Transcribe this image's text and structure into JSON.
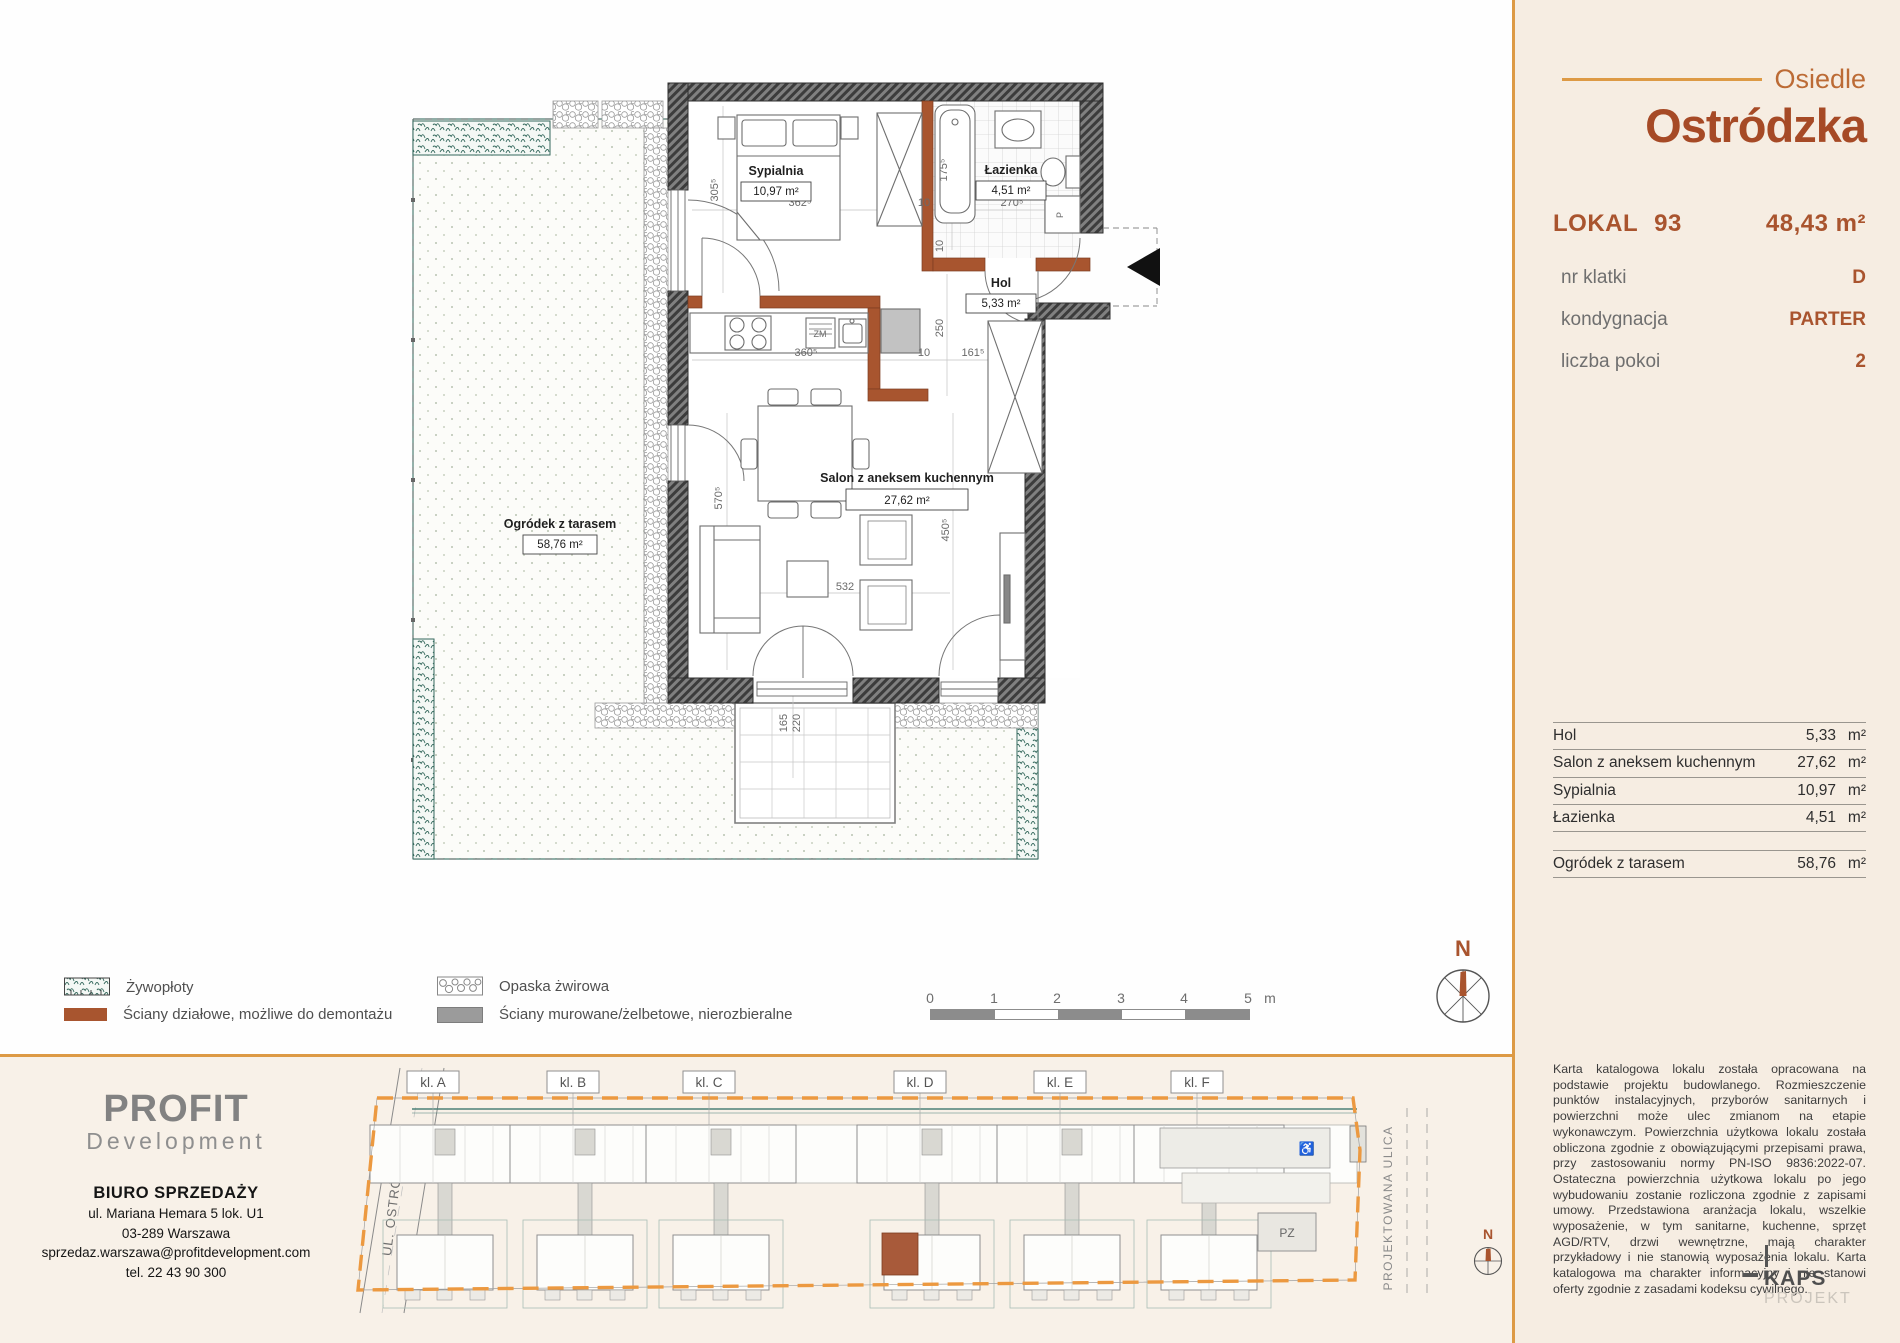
{
  "sidebar": {
    "brand": {
      "label": "Osiedle",
      "name": "Ostródzka"
    },
    "lokal": {
      "label": "LOKAL",
      "number": "93",
      "area": "48,43",
      "unit": "m²"
    },
    "attributes": [
      {
        "label": "nr klatki",
        "value": "D"
      },
      {
        "label": "kondygnacja",
        "value": "PARTER"
      },
      {
        "label": "liczba pokoi",
        "value": "2"
      }
    ],
    "rooms": [
      {
        "name": "Hol",
        "area": "5,33",
        "unit": "m²"
      },
      {
        "name": "Salon z aneksem kuchennym",
        "area": "27,62",
        "unit": "m²"
      },
      {
        "name": "Sypialnia",
        "area": "10,97",
        "unit": "m²"
      },
      {
        "name": "Łazienka",
        "area": "4,51",
        "unit": "m²"
      }
    ],
    "outdoor": {
      "name": "Ogródek z tarasem",
      "area": "58,76",
      "unit": "m²"
    },
    "disclaimer": "Karta katalogowa lokalu została opracowana na podstawie projektu budowlanego. Rozmieszczenie punktów instalacyjnych, przyborów sanitarnych i powierzchni może ulec zmianom na etapie wykonawczym. Powierzchnia użytkowa lokalu została obliczona zgodnie z obowiązującymi przepisami prawa, przy zastosowaniu normy PN-ISO 9836:2022-07. Ostateczna powierzchnia użytkowa lokalu po jego wybudowaniu zostanie rozliczona zgodnie z zapisami umowy. Przedstawiona aranżacja lokalu, wszelkie wyposażenie, w tym sanitarne, kuchenne, sprzęt AGD/RTV, drzwi wewnętrzne, mają charakter przykładowy i nie stanowią wyposażenia lokalu. Karta katalogowa ma charakter informacyjny i nie stanowi oferty zgodnie z zasadami kodeksu cywilnego.",
    "studio": {
      "name": "KAPS",
      "sub": "PROJEKT"
    }
  },
  "plan": {
    "labels": {
      "sypialnia": {
        "name": "Sypialnia",
        "area": "10,97 m²"
      },
      "lazienka": {
        "name": "Łazienka",
        "area": "4,51 m²"
      },
      "hol": {
        "name": "Hol",
        "area": "5,33 m²"
      },
      "salon": {
        "name": "Salon z aneksem kuchennym",
        "area": "27,62 m²"
      },
      "ogrodek": {
        "name": "Ogródek z tarasem",
        "area": "58,76 m²"
      }
    },
    "dims": {
      "bedroom_h": "305⁵",
      "bedroom_w": "362⁵",
      "wall1": "10",
      "bath_w": "270⁵",
      "tub_h": "175⁵",
      "wall2": "10",
      "hol_h": "250",
      "kitchen_w": "360⁵",
      "wall3": "10",
      "hol_w": "161⁵",
      "salon_h1": "570⁵",
      "salon_h2": "450⁵",
      "salon_w": "532",
      "terrace_w": "165",
      "terrace_h": "220"
    },
    "appliances": {
      "dishwasher": "ZM",
      "washer": "P"
    }
  },
  "legend": {
    "items": [
      {
        "label": "Żywopłoty"
      },
      {
        "label": "Ściany działowe, możliwe do demontażu"
      },
      {
        "label": "Opaska żwirowa"
      },
      {
        "label": "Ściany murowane/żelbetowe, nierozbieralne"
      }
    ]
  },
  "scalebar": {
    "ticks": [
      "0",
      "1",
      "2",
      "3",
      "4",
      "5"
    ],
    "unit": "m"
  },
  "compass": {
    "label": "N"
  },
  "developer": {
    "logo_main": "PROFIT",
    "logo_sub": "Development",
    "office": "BIURO SPRZEDAŻY",
    "address_line1": "ul. Mariana Hemara 5 lok. U1",
    "address_line2": "03-289 Warszawa",
    "email": "sprzedaz.warszawa@profitdevelopment.com",
    "phone": "tel. 22 43 90 300"
  },
  "siteplan": {
    "street_left": "UL. OSTRÓDZKA",
    "street_right": "PROJEKTOWANA ULICA",
    "buildings": [
      "kl. A",
      "kl. B",
      "kl. C",
      "kl. D",
      "kl. E",
      "kl. F"
    ],
    "parking": "PZ",
    "compass": "N",
    "accessible_icon": "♿"
  },
  "colors": {
    "accent_orange": "#DD9A45",
    "rust": "#A9542E",
    "title": "#A64A26",
    "sidebar_bg": "#F6EDE2",
    "bottom_bg": "#F8F1E8",
    "teal": "#3E7467",
    "gray_wall": "#9B9B9B"
  }
}
